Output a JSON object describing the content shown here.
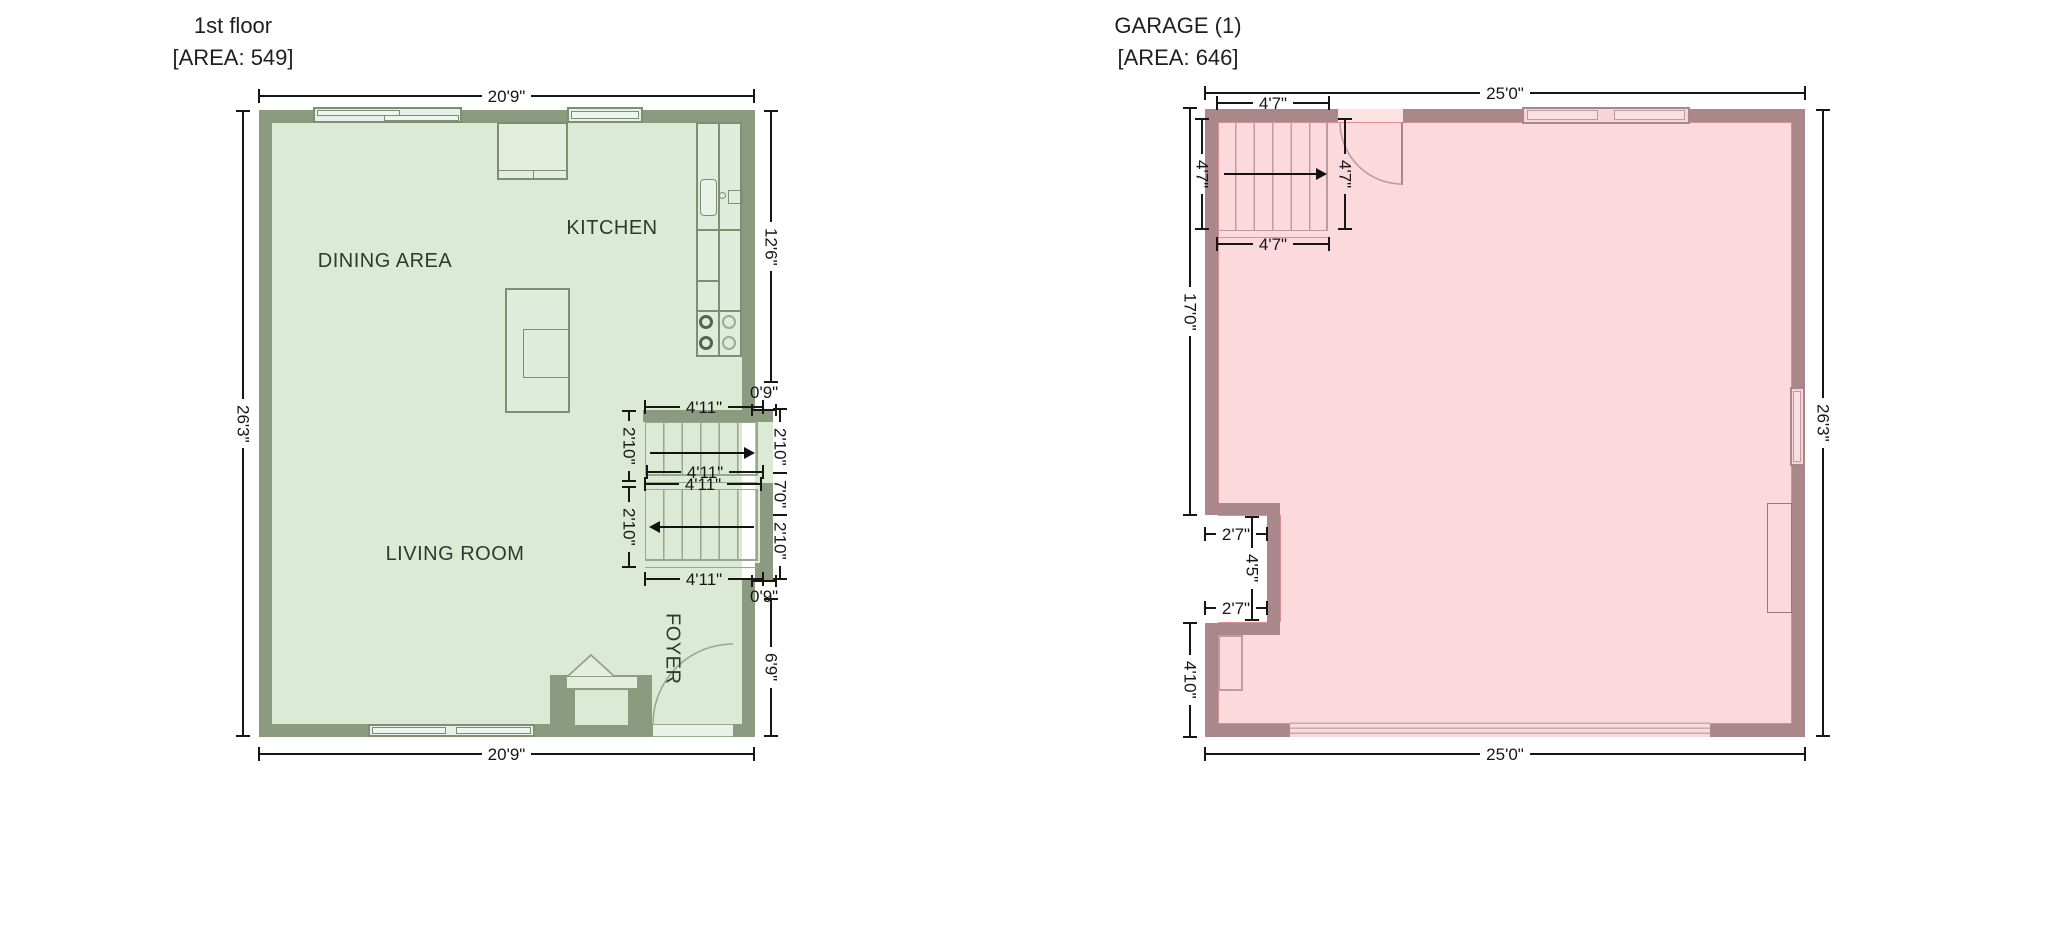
{
  "plans": {
    "floor1": {
      "title": "1st floor",
      "area_label": "[AREA: 549]",
      "rooms": {
        "dining": "DINING AREA",
        "kitchen": "KITCHEN",
        "living": "LIVING ROOM",
        "foyer": "FOYER"
      },
      "dims": {
        "width_top": "20'9\"",
        "width_bottom": "20'9\"",
        "height_left": "26'3\"",
        "kitchen_right": "12'6\"",
        "bump_top_offset": "0'9\"",
        "bump_bottom_offset": "0'9\"",
        "bump_upper": "2'10\"",
        "bump_total": "7'0\"",
        "bump_lower": "2'10\"",
        "foyer_right": "6'9\"",
        "stair_width_top": "4'11\"",
        "stair_width_mid_upper": "4'11\"",
        "stair_width_mid_lower": "4'11\"",
        "stair_width_bottom": "4'11\"",
        "stair_run_upper": "2'10\"",
        "stair_run_lower": "2'10\""
      }
    },
    "garage": {
      "title": "GARAGE (1)",
      "area_label": "[AREA: 646]",
      "dims": {
        "width_top": "25'0\"",
        "width_bottom": "25'0\"",
        "height_right": "26'3\"",
        "left_upper": "17'0\"",
        "left_lower": "4'10\"",
        "stair_width_top": "4'7\"",
        "stair_width_bottom": "4'7\"",
        "stair_height_left": "4'7\"",
        "stair_height_right": "4'7\"",
        "notch_top": "2'7\"",
        "notch_height": "4'5\"",
        "notch_bottom": "2'7\""
      }
    }
  },
  "colors": {
    "floor1_wall": "#8b9b7f",
    "floor1_floor": "#dbe9d5",
    "floor1_outline": "#7d8f73",
    "garage_wall": "#aa878b",
    "garage_floor": "#fcd9dc",
    "garage_outline": "#bb9ca0",
    "dimension_text": "#161616"
  }
}
